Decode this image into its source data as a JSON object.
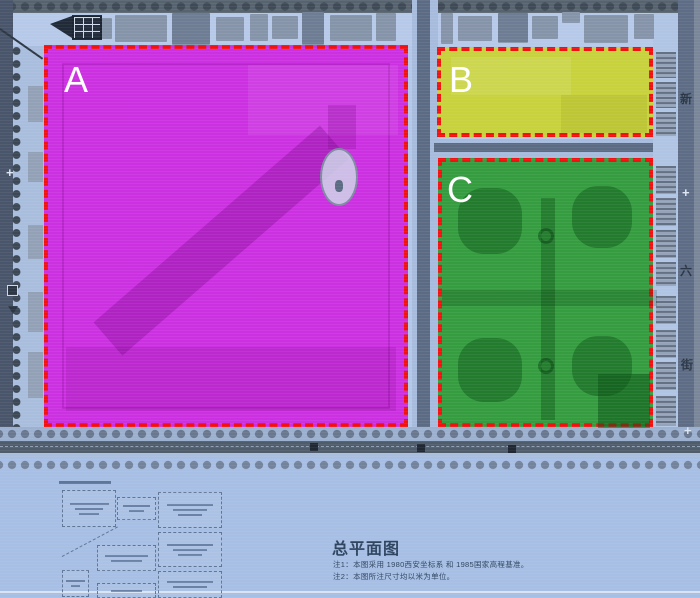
{
  "plan": {
    "title": "总平面图",
    "notes": [
      "注1：本图采用 1980西安坐标系 和 1985国家高程基准。",
      "注2：本图所注尺寸均以米为单位。"
    ]
  },
  "zones": [
    {
      "label": "A",
      "fill": "#cd26e0",
      "border": "#f21111"
    },
    {
      "label": "B",
      "fill": "#c9d32e",
      "border": "#f21111"
    },
    {
      "label": "C",
      "fill": "#2b9a33",
      "border": "#f21111"
    }
  ],
  "road_labels": {
    "right_street_chars": [
      "新",
      "六",
      "街"
    ]
  },
  "symbols": {
    "cross": "+"
  },
  "colors": {
    "map_background": "#b3c7e8",
    "road": "#5d6c84",
    "building": "#8694aa",
    "panel_background": "#a7bfe4",
    "zone_label_text": "#ffffff",
    "note_text": "#2f4560"
  }
}
